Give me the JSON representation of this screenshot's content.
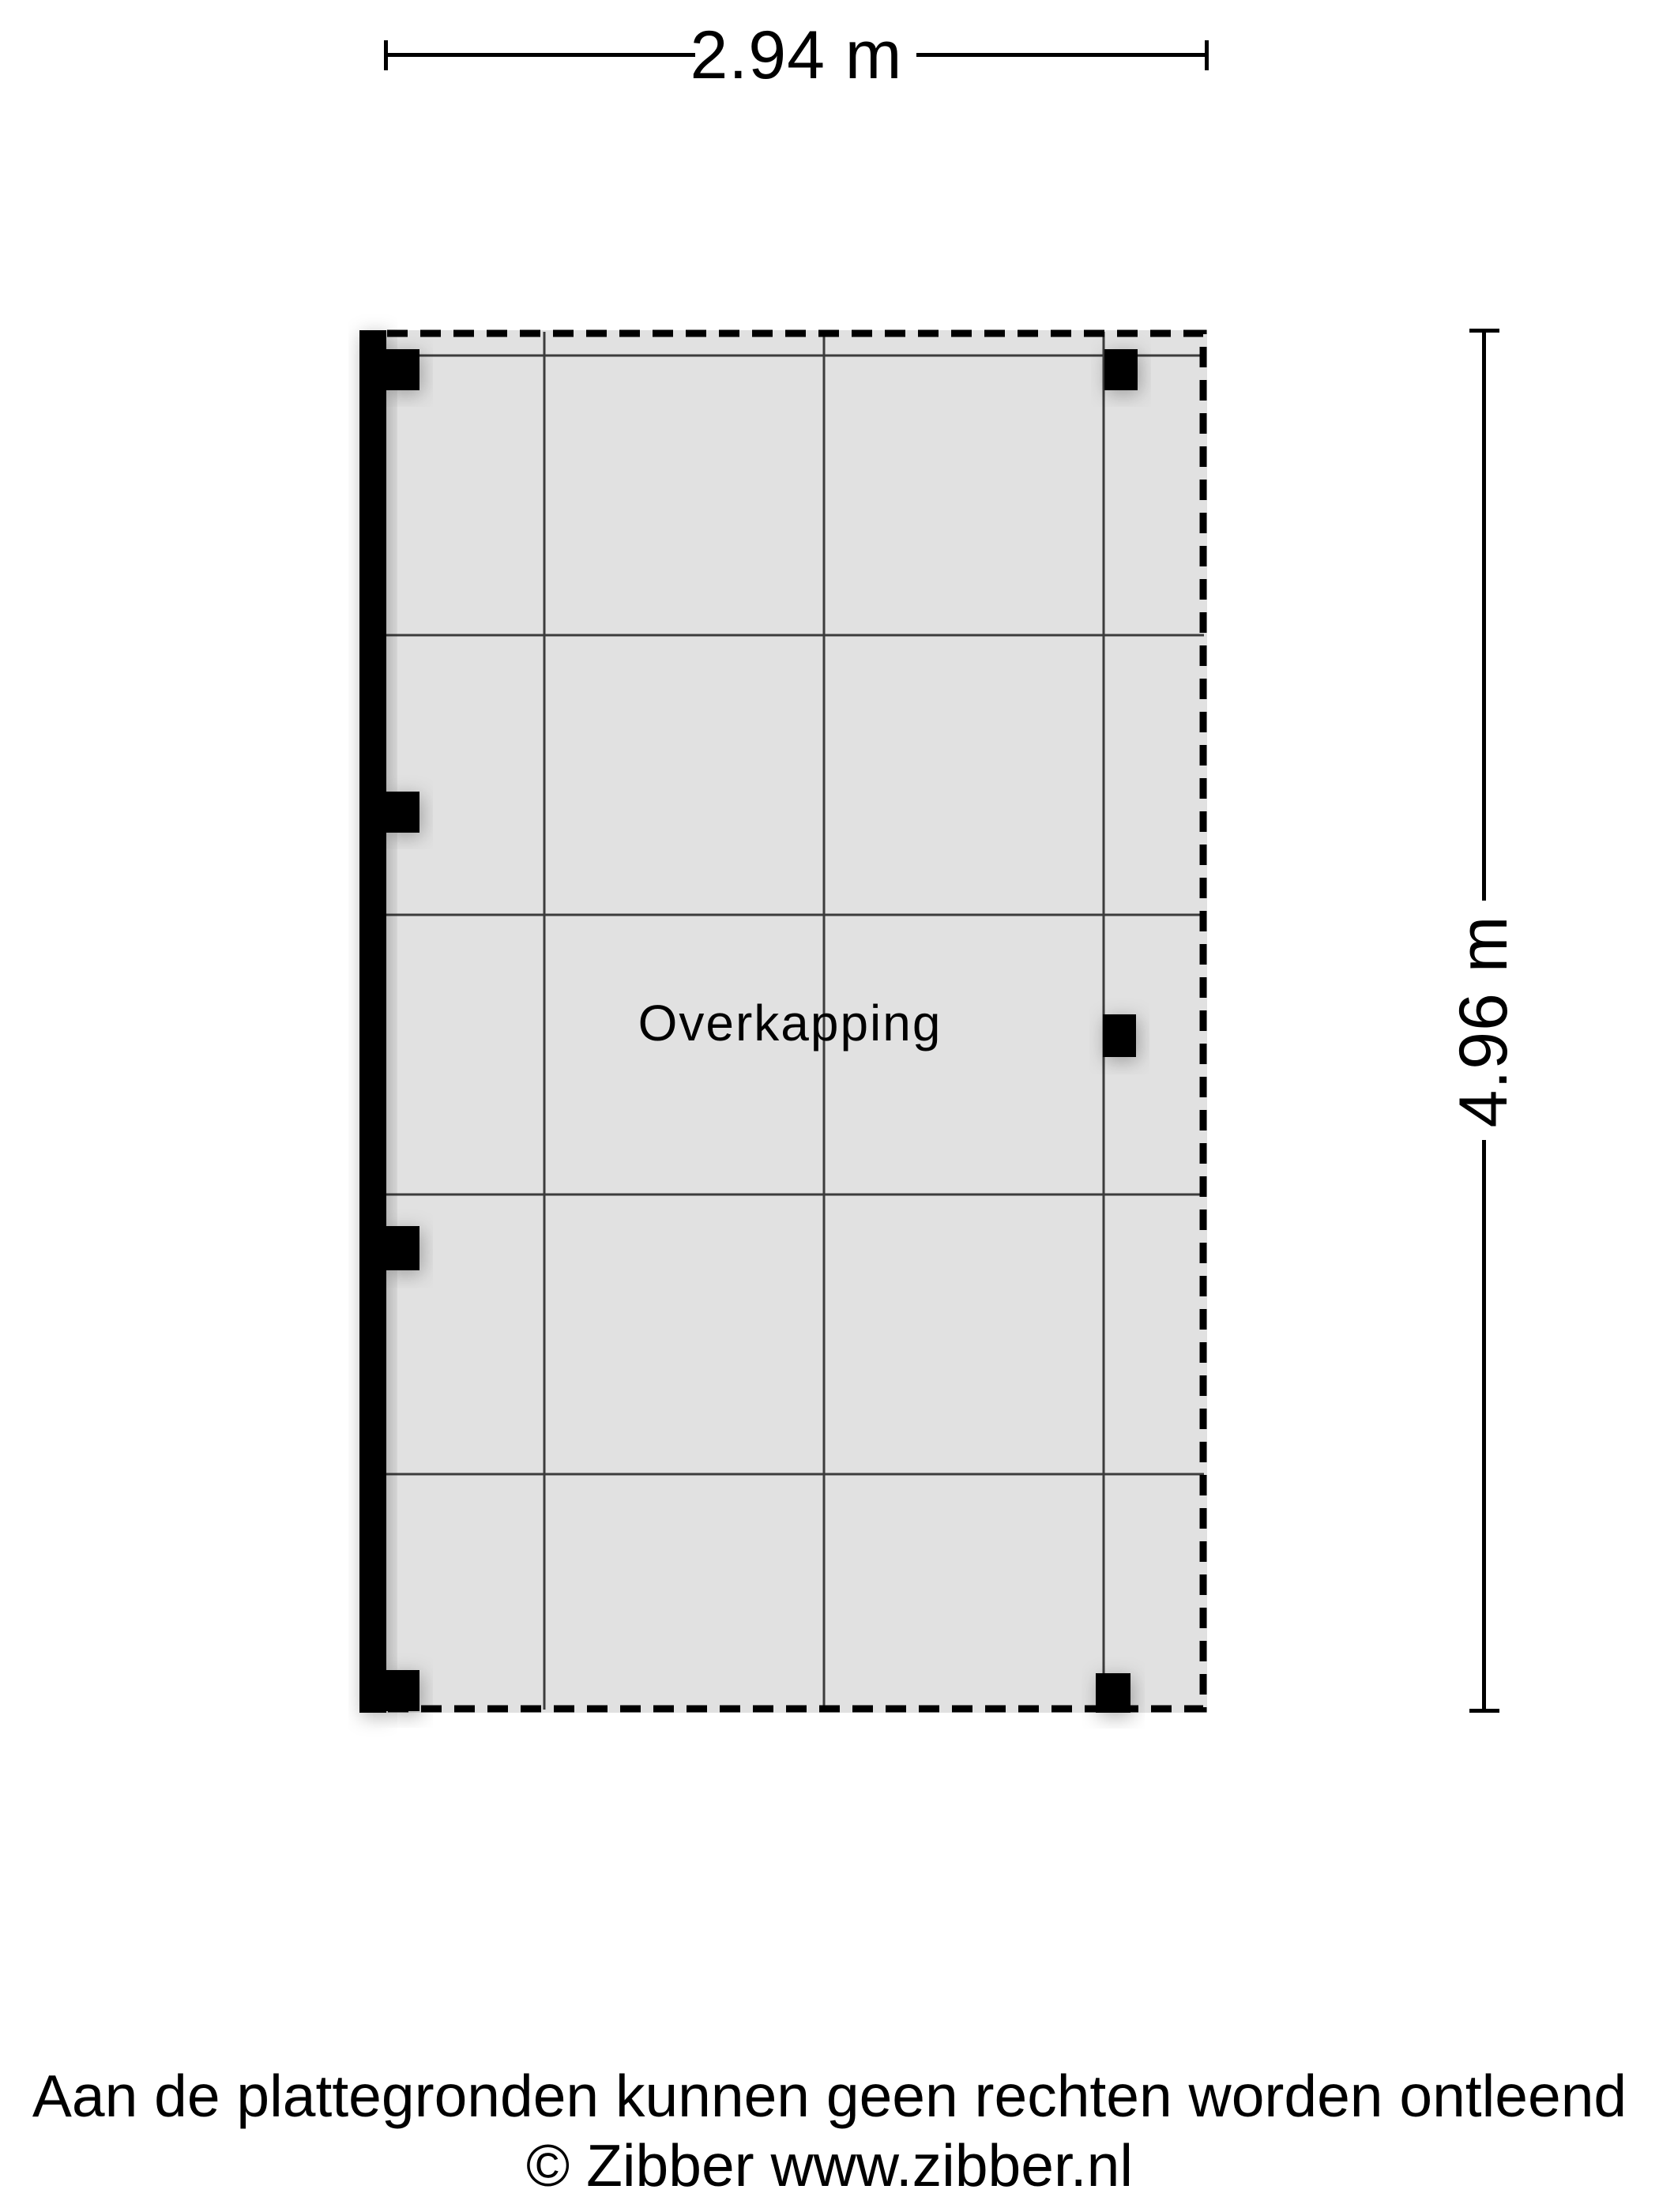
{
  "dimensions": {
    "top": {
      "label": "2.94 m"
    },
    "right": {
      "label": "4.96 m"
    }
  },
  "room": {
    "label": "Overkapping"
  },
  "footer": {
    "disclaimer": "Aan de plattegronden kunnen geen rechten worden ontleend",
    "copyright": "© Zibber www.zibber.nl"
  },
  "colors": {
    "page_bg": "#ffffff",
    "floor_fill": "#e1e1e1",
    "grid_line": "#3c3c3c",
    "structure": "#000000",
    "text": "#000000"
  }
}
